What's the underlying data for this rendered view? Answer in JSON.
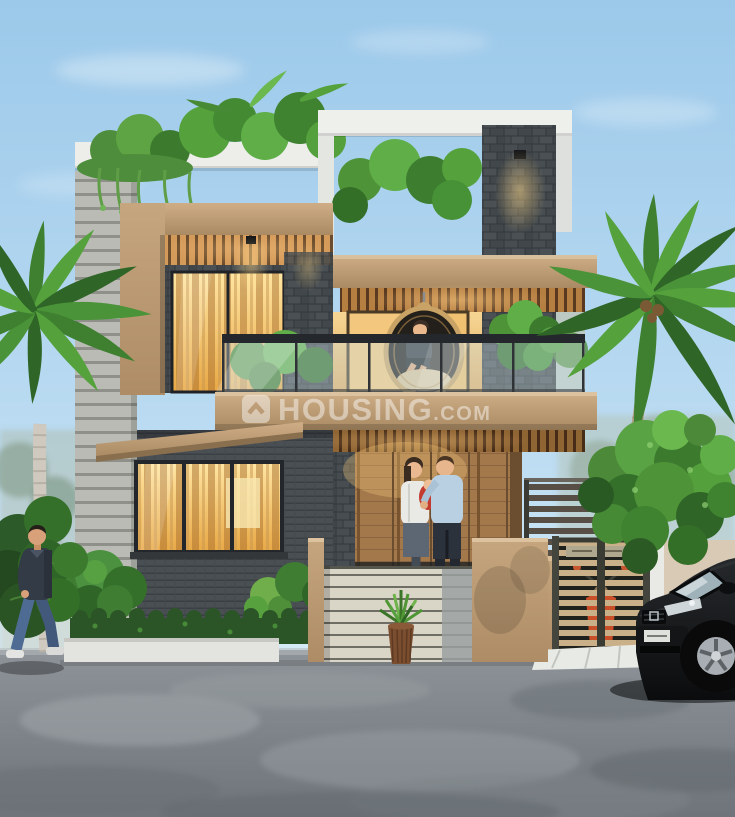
{
  "scene": {
    "kind": "3D architectural exterior render of a modern two-storey house",
    "watermark": {
      "icon": "housing-logo-house-icon",
      "brand": "HOUSING",
      "suffix": ".COM"
    },
    "house": {
      "storeys": "two",
      "features": [
        "rooftop plants",
        "wood slat ceilings",
        "glass balcony railing",
        "hanging egg chair",
        "warm lit curtained windows",
        "dark stone clad pillars",
        "grey horizontal siding wing",
        "striped compound wall panel",
        "slatted metal gate with scooter behind",
        "white tiled driveway ramp"
      ]
    },
    "people": [
      "man walking on road at left",
      "couple with baby on porch",
      "woman seated in hanging chair"
    ],
    "vehicles": [
      "black SUV at right edge",
      "orange scooter behind gate"
    ],
    "vegetation": [
      "palm tree left",
      "palm tree right",
      "leafy tree at right",
      "shrubs and hedge",
      "rooftop hanging vines",
      "potted plant by wall"
    ],
    "environment": {
      "sky": "clear light blue with wispy clouds",
      "background": "misty trees",
      "foreground": "grey asphalt road"
    },
    "palette": {
      "sky_top": "#9cc9ea",
      "sky_horizon": "#d9ecf7",
      "facade_tan": "#bf9e78",
      "facade_light_grey": "#b9bbb4",
      "stone_dark": "#43484c",
      "wood_slats": "#d49a5a",
      "window_glow": "#f4c468",
      "glass_railing": "#cfe4ea",
      "foliage_green": "#4f9338",
      "road_grey": "#82888d",
      "suv_black": "#141618",
      "scooter_orange": "#c84f28",
      "watermark_white": "#ffffff"
    }
  }
}
